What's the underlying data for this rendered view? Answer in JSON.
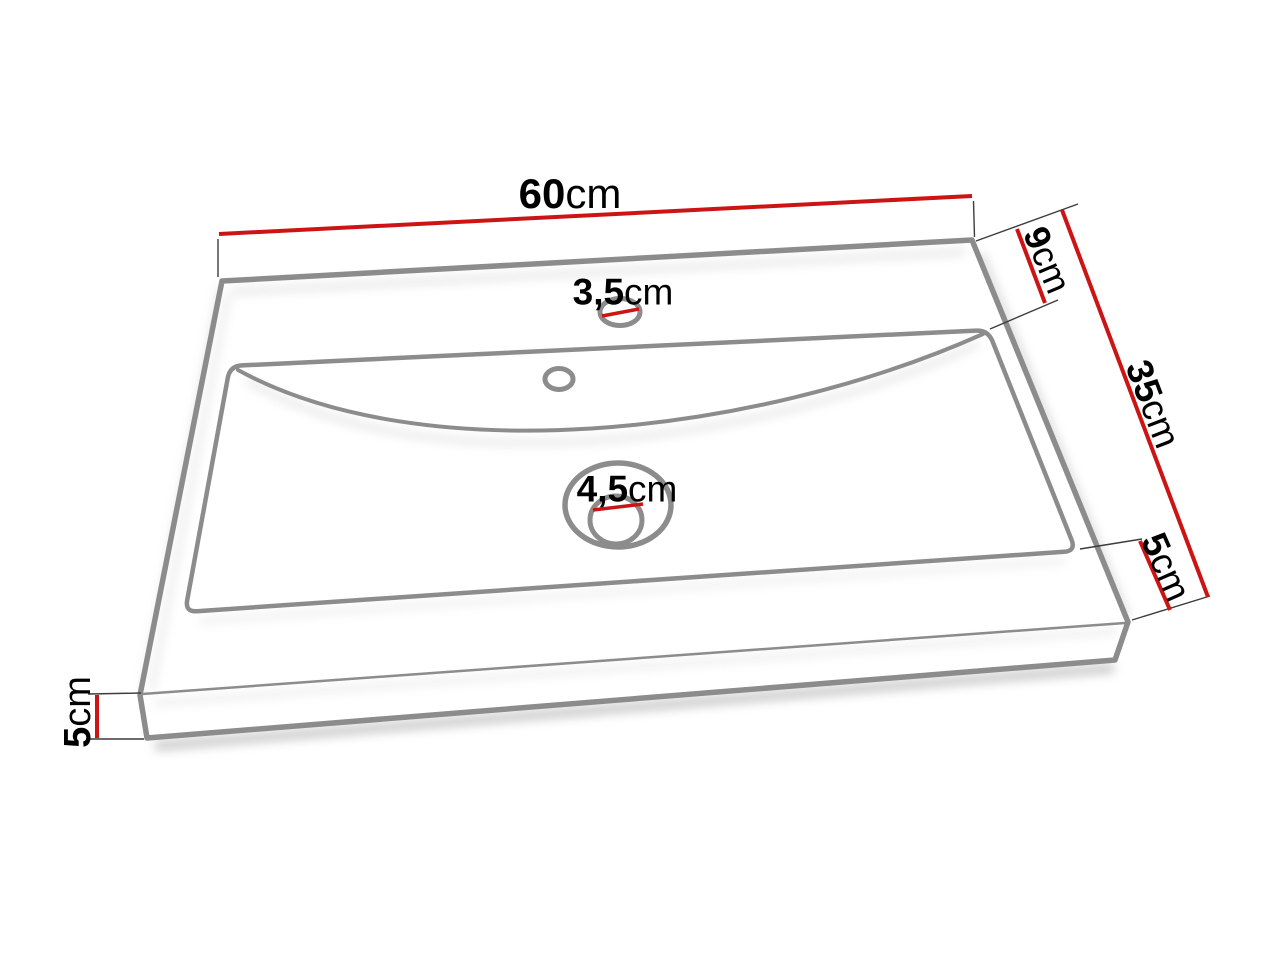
{
  "diagram": {
    "subject": "washbasin-dimension-drawing",
    "dimensions": {
      "width": {
        "value": "60",
        "unit": "cm"
      },
      "back_depth": {
        "value": "9",
        "unit": "cm"
      },
      "depth": {
        "value": "35",
        "unit": "cm"
      },
      "front_depth": {
        "value": "5",
        "unit": "cm"
      },
      "height": {
        "value": "5",
        "unit": "cm"
      },
      "tap_hole": {
        "value": "3,5",
        "unit": "cm"
      },
      "drain_hole": {
        "value": "4,5",
        "unit": "cm"
      }
    },
    "colors": {
      "dimension_line": "#cd1414",
      "outline": "#8c8c8c",
      "extension": "#3c3c3c",
      "text": "#000000",
      "background": "#ffffff"
    }
  }
}
